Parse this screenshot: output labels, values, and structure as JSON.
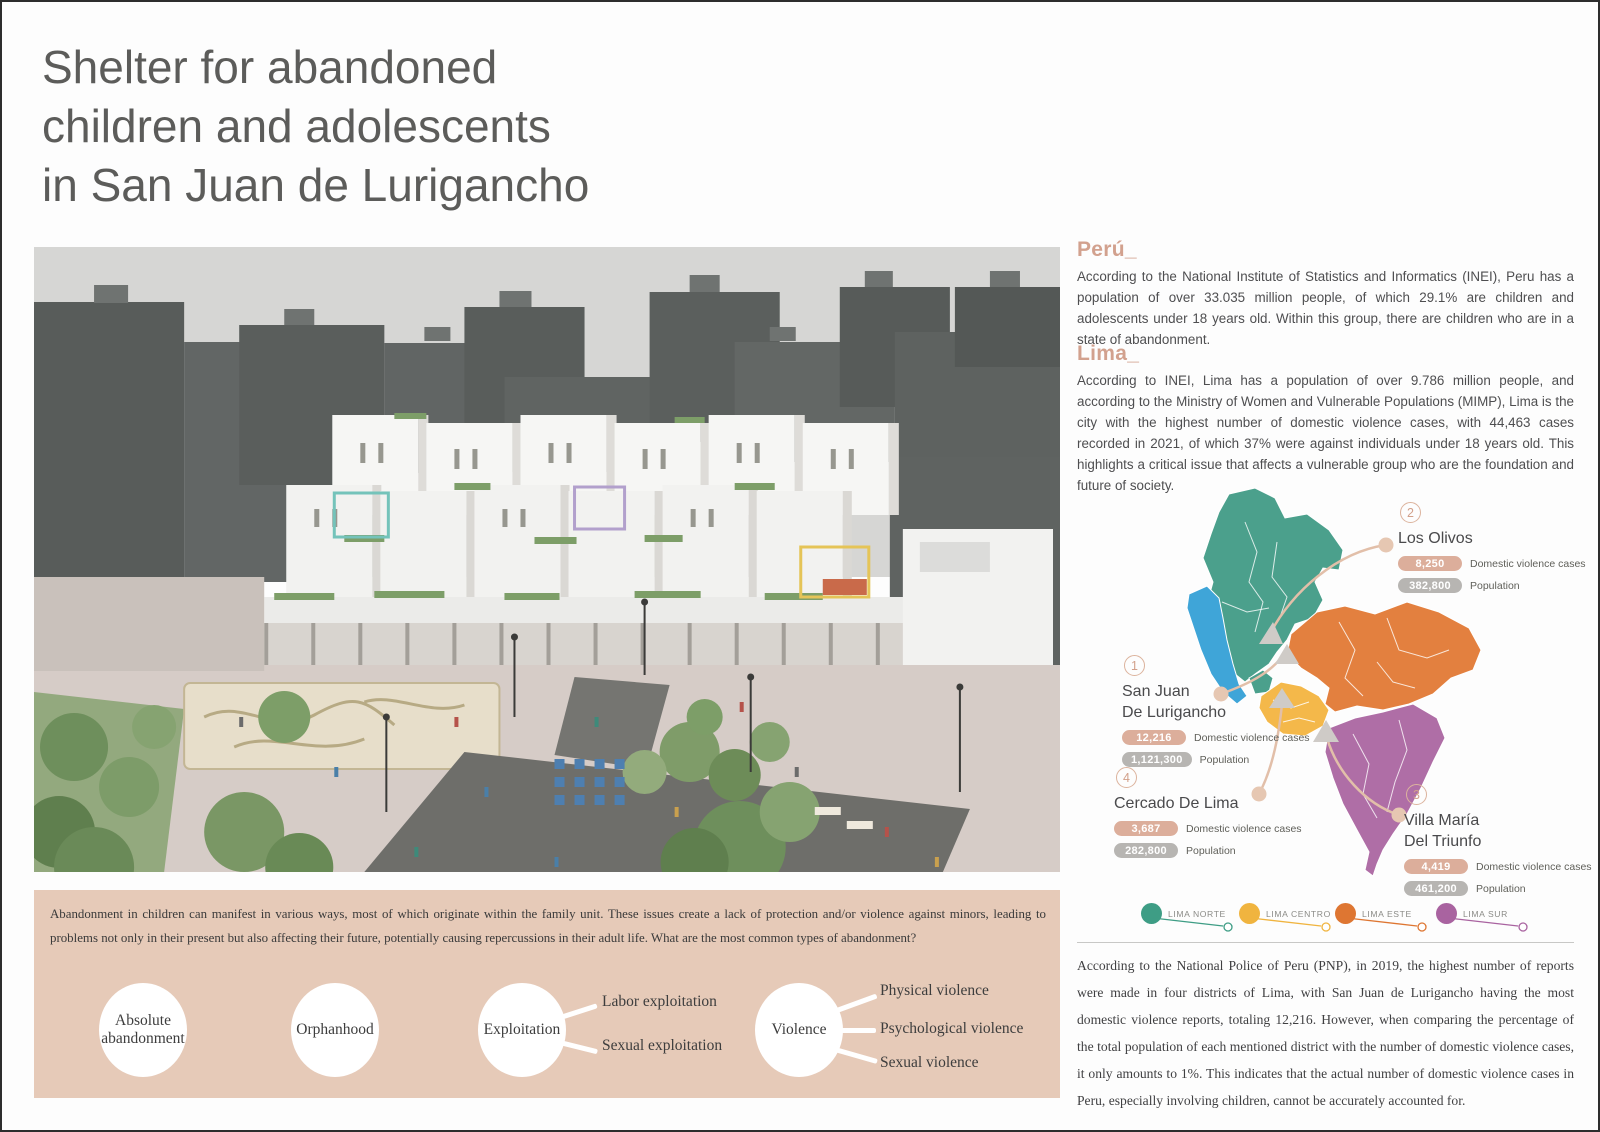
{
  "title": {
    "line1": "Shelter for abandoned",
    "line2": "children and adolescents",
    "line3": "in San Juan de Lurigancho"
  },
  "sections": {
    "peru": {
      "heading": "Perú_",
      "body": "According to the National Institute of Statistics and Informatics (INEI), Peru has a population of over 33.035 million people, of which 29.1% are children and adolescents under 18 years old. Within this group, there are children who are in a state of abandonment."
    },
    "lima": {
      "heading": "Lima_",
      "body": "According to INEI, Lima has a population of over 9.786 million people, and according to the Ministry of Women and Vulnerable Populations (MIMP), Lima is the city with the highest number of domestic violence cases, with 44,463 cases recorded in 2021, of which 37% were against individuals under 18 years old. This highlights a critical issue that affects a vulnerable group who are the foundation and future of society."
    },
    "pnp": {
      "body": "According to the National Police of Peru (PNP), in 2019, the highest number of reports were made in four districts of Lima, with San Juan de Lurigancho having the most domestic violence reports, totaling 12,216. However, when comparing the percentage of the total population of each mentioned district with the number of domestic violence cases, it only amounts to 1%. This indicates that the actual number of domestic violence cases in Peru, especially involving children, cannot be accurately accounted for."
    }
  },
  "map": {
    "callouts": [
      {
        "number": "1",
        "name1": "San Juan",
        "name2": "De Lurigancho",
        "cases": "12,216",
        "cases_label": "Domestic violence cases",
        "population": "1,121,300",
        "population_label": "Population"
      },
      {
        "number": "2",
        "name1": "Los Olivos",
        "name2": "",
        "cases": "8,250",
        "cases_label": "Domestic violence cases",
        "population": "382,800",
        "population_label": "Population"
      },
      {
        "number": "3",
        "name1": "Villa María",
        "name2": "Del Triunfo",
        "cases": "4,419",
        "cases_label": "Domestic violence cases",
        "population": "461,200",
        "population_label": "Population"
      },
      {
        "number": "4",
        "name1": "Cercado De Lima",
        "name2": "",
        "cases": "3,687",
        "cases_label": "Domestic violence cases",
        "population": "282,800",
        "population_label": "Population"
      }
    ],
    "legend": [
      {
        "label": "LIMA NORTE",
        "color": "#3E9D85"
      },
      {
        "label": "LIMA CENTRO",
        "color": "#F0B43F"
      },
      {
        "label": "LIMA ESTE",
        "color": "#DE7632"
      },
      {
        "label": "LIMA SUR",
        "color": "#A963A0"
      }
    ],
    "region_colors": {
      "lima_norte": "#4BA08C",
      "lima_centro": "#F4B84A",
      "lima_este": "#E3803F",
      "lima_sur": "#AF6EA6",
      "callao": "#3FA5D8"
    }
  },
  "abandonment": {
    "intro": "Abandonment in children can manifest in various ways, most of which originate within the family unit. These issues create a lack of protection and/or violence against minors, leading to problems not only in their present but also affecting their future, potentially causing repercussions in their adult life. What are the most common types of abandonment?",
    "types": [
      {
        "line1": "Absolute",
        "line2": "abandonment"
      },
      {
        "line1": "Orphanhood",
        "line2": ""
      },
      {
        "line1": "Exploitation",
        "line2": ""
      },
      {
        "line1": "Violence",
        "line2": ""
      }
    ],
    "branches": {
      "exploitation": [
        "Labor exploitation",
        "Sexual exploitation"
      ],
      "violence": [
        "Physical violence",
        "Psychological violence",
        "Sexual violence"
      ]
    }
  },
  "colors": {
    "accent_tan": "#D2A18E",
    "pill_tan": "#DCAE9B",
    "pill_gray": "#B7B5B2",
    "panel_tan": "#E6CAB8",
    "title_gray": "#5C5C5A"
  }
}
